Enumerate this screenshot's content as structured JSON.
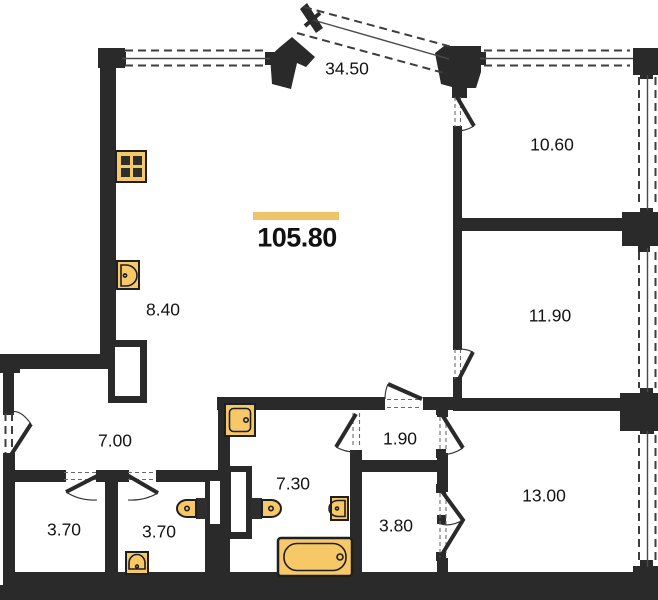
{
  "title": "Apartment floor plan",
  "total_area": "105.80",
  "rooms": [
    {
      "name": "terrace",
      "area": "34.50"
    },
    {
      "name": "bedroom-top",
      "area": "10.60"
    },
    {
      "name": "kitchen-zone",
      "area": "8.40"
    },
    {
      "name": "bedroom-middle",
      "area": "11.90"
    },
    {
      "name": "hallway",
      "area": "7.00"
    },
    {
      "name": "wardrobe-small",
      "area": "1.90"
    },
    {
      "name": "bathroom",
      "area": "7.30"
    },
    {
      "name": "storage",
      "area": "3.80"
    },
    {
      "name": "bedroom-bottom",
      "area": "13.00"
    },
    {
      "name": "wc-left",
      "area": "3.70"
    },
    {
      "name": "wc-right",
      "area": "3.70"
    }
  ],
  "fixtures": [
    "stove-icon",
    "kitchen-sink-icon",
    "bathroom-square-sink-icon",
    "toilet-icon",
    "toilet-icon",
    "washbasin-icon",
    "washbasin-icon",
    "bathtub-icon"
  ],
  "colors": {
    "wall": "#2a2a2a",
    "fixture-fill": "#f7c868",
    "accent-bar": "#eec46a",
    "background": "#ffffff",
    "label": "#141414"
  }
}
